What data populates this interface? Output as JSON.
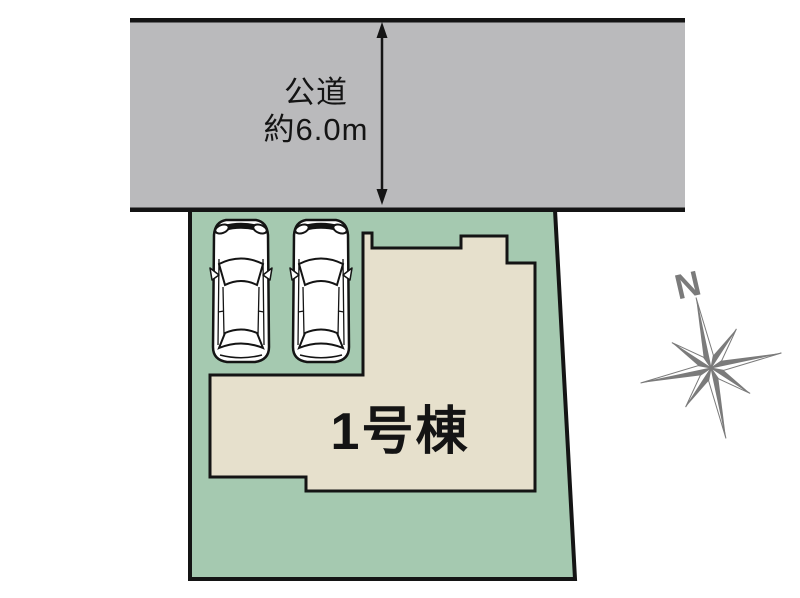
{
  "diagram": {
    "road": {
      "label_line1": "公道",
      "label_line2": "約6.0m",
      "fill_color": "#bababc",
      "border_color": "#141414"
    },
    "plot": {
      "fill_color": "#a5c9b0",
      "border_color": "#141414"
    },
    "building": {
      "label": "1号棟",
      "fill_color": "#e6e0cc",
      "border_color": "#141414"
    },
    "parking": {
      "car_count": 2
    },
    "compass": {
      "label": "N",
      "color": "#7b7b7b"
    }
  }
}
